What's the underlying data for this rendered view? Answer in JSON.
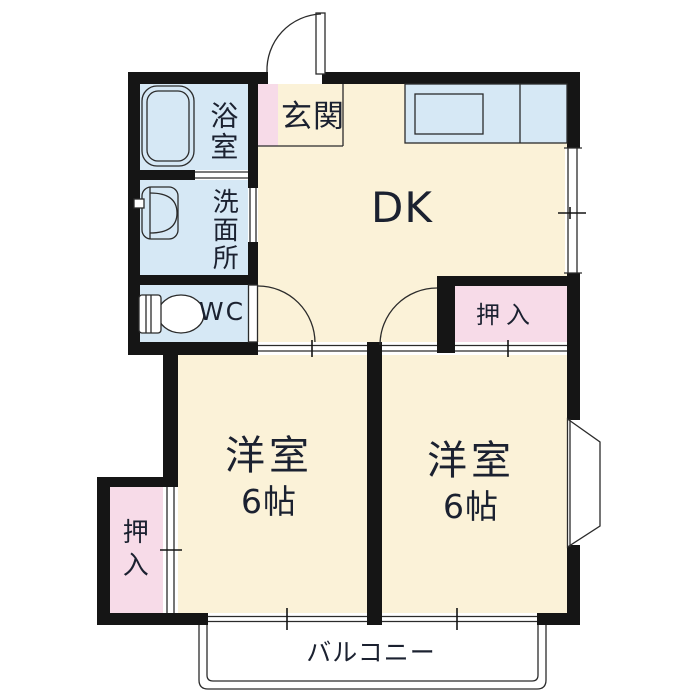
{
  "rooms": {
    "genkan": {
      "label": "玄関"
    },
    "dk": {
      "label": "DK"
    },
    "bathroom": {
      "label": "浴室"
    },
    "washroom": {
      "label": "洗面所"
    },
    "wc": {
      "label": "WC"
    },
    "closet_dk": {
      "label": "押入"
    },
    "bedroom_left": {
      "label": "洋室",
      "size": "6帖"
    },
    "bedroom_right": {
      "label": "洋室",
      "size": "6帖"
    },
    "closet_left": {
      "label": "押入"
    },
    "balcony": {
      "label": "バルコニー"
    }
  },
  "fixtures": {
    "bathtub_icon": "bathtub-top-view",
    "washbasin_icon": "washbasin-with-tap",
    "toilet_icon": "toilet-top-view",
    "kitchen_counter_icon": "kitchen-counter-with-sink",
    "entrance_door_icon": "swing-door-arc",
    "wc_door_icon": "swing-door-arc",
    "bedroom_door_icon": "swing-door-arc",
    "sliding_door_icon": "double-line-sliding-door",
    "window_icon": "double-line-window",
    "bay_window_icon": "trapezoid-bay-window"
  },
  "colors": {
    "wall_black": "#151515",
    "line_dark": "#2b2b2b",
    "room_cream": "#FBF2D8",
    "wet_blue": "#D6E8F5",
    "closet_pink": "#F7DBE8",
    "text_dark": "#1b2130"
  }
}
